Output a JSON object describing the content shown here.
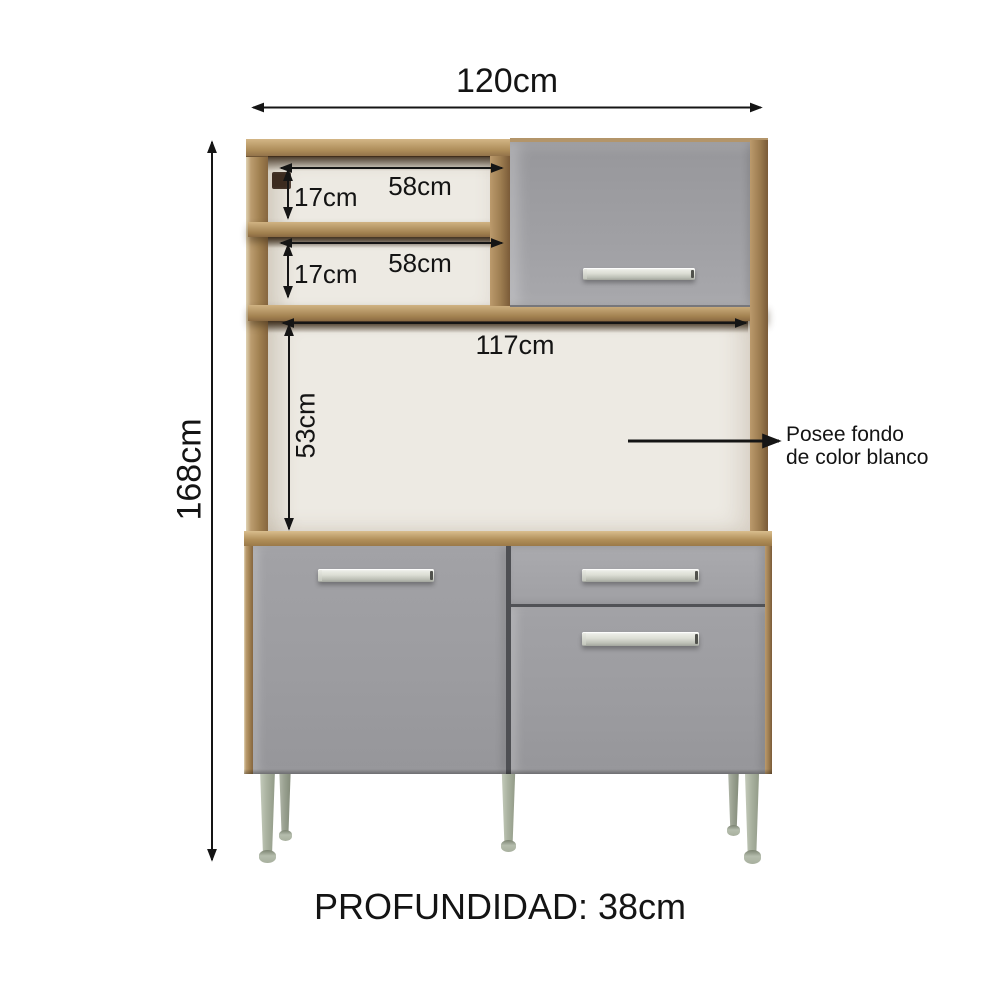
{
  "labels": {
    "overall_width": "120cm",
    "overall_height": "168cm",
    "shelf1_width": "58cm",
    "shelf1_height": "17cm",
    "shelf2_width": "58cm",
    "shelf2_height": "17cm",
    "open_width": "117cm",
    "open_height": "53cm",
    "depth": "PROFUNDIDAD: 38cm"
  },
  "annotation": {
    "line1": "Posee fondo",
    "line2": "de color blanco"
  },
  "colors": {
    "wood": "#a8895a",
    "wood-light": "#cfb285",
    "wood-dark": "#7a5b38",
    "shadow-brown": "#3c2b1f",
    "door-gray": "#9d9da1",
    "back-white": "#edeae3",
    "leg-sage": "#abb3a1",
    "handle-silver": "#dcded5",
    "dimension-line": "#151515"
  }
}
